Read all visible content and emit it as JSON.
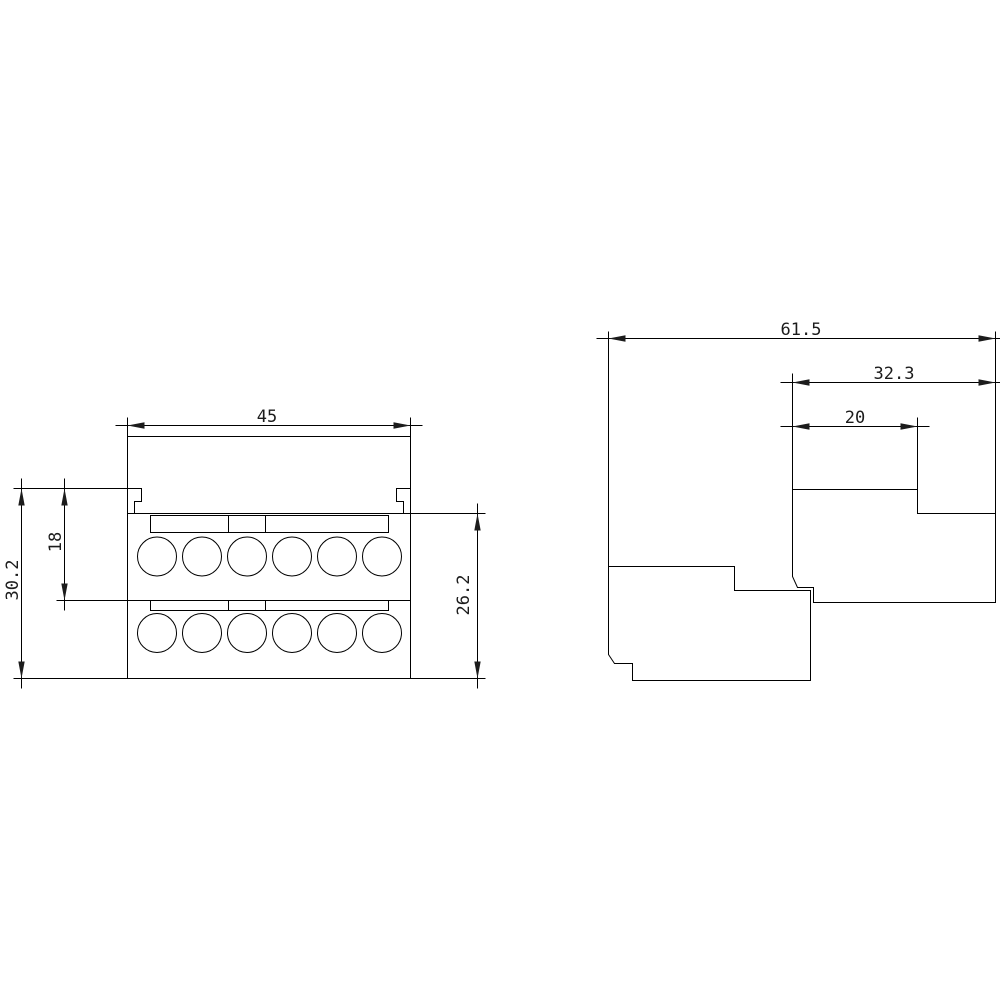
{
  "document": {
    "type": "technical dimension drawing",
    "background_color": "#ffffff",
    "line_color": "#000000",
    "text_color": "#1c1c1c"
  },
  "front_view": {
    "description": "front view of terminal block with two rows of terminal holes",
    "terminal_rows": 2,
    "terminals_per_row": 6,
    "dims": {
      "width": "45",
      "overall_height": "30.2",
      "upper_height": "18",
      "body_height": "26.2"
    }
  },
  "side_view": {
    "description": "side view with stepped profile, two overlapping bodies",
    "dims": {
      "overall_depth": "61.5",
      "upper_depth": "32.3",
      "top_step_depth": "20"
    }
  }
}
